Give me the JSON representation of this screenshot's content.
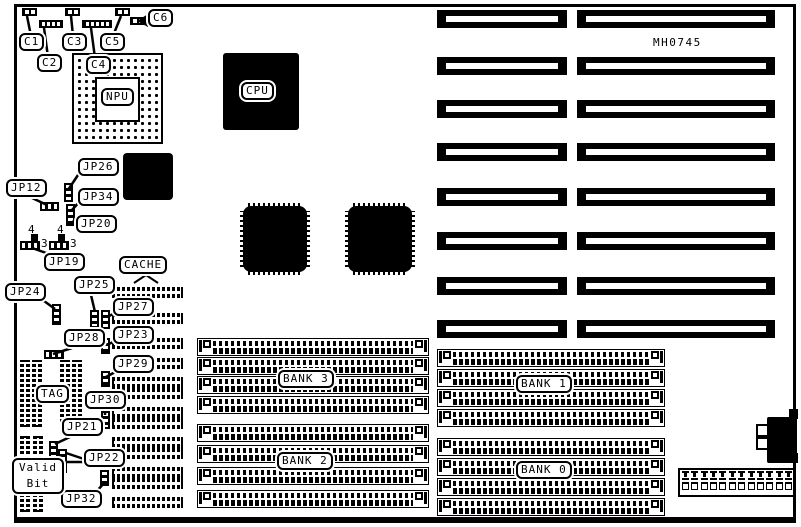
{
  "diagram": {
    "part_number": "MH0745",
    "callouts": {
      "c1": "C1",
      "c2": "C2",
      "c3": "C3",
      "c4": "C4",
      "c5": "C5",
      "c6": "C6",
      "jp12": "JP12",
      "jp19": "JP19",
      "jp20": "JP20",
      "jp21": "JP21",
      "jp22": "JP22",
      "jp23": "JP23",
      "jp24": "JP24",
      "jp25": "JP25",
      "jp26": "JP26",
      "jp27": "JP27",
      "jp28": "JP28",
      "jp29": "JP29",
      "jp30": "JP30",
      "jp32": "JP32",
      "jp34": "JP34",
      "npu": "NPU",
      "cpu": "CPU",
      "cache": "CACHE",
      "tag": "TAG"
    },
    "valid_bit": {
      "line1": "Valid",
      "line2": "Bit"
    },
    "banks": {
      "bank0": "BANK 0",
      "bank1": "BANK 1",
      "bank2": "BANK 2",
      "bank3": "BANK 3"
    },
    "pin_numbers": {
      "jp19_top": "4",
      "jp19_right": "3",
      "jp20_top": "4",
      "jp20_right": "3"
    }
  }
}
